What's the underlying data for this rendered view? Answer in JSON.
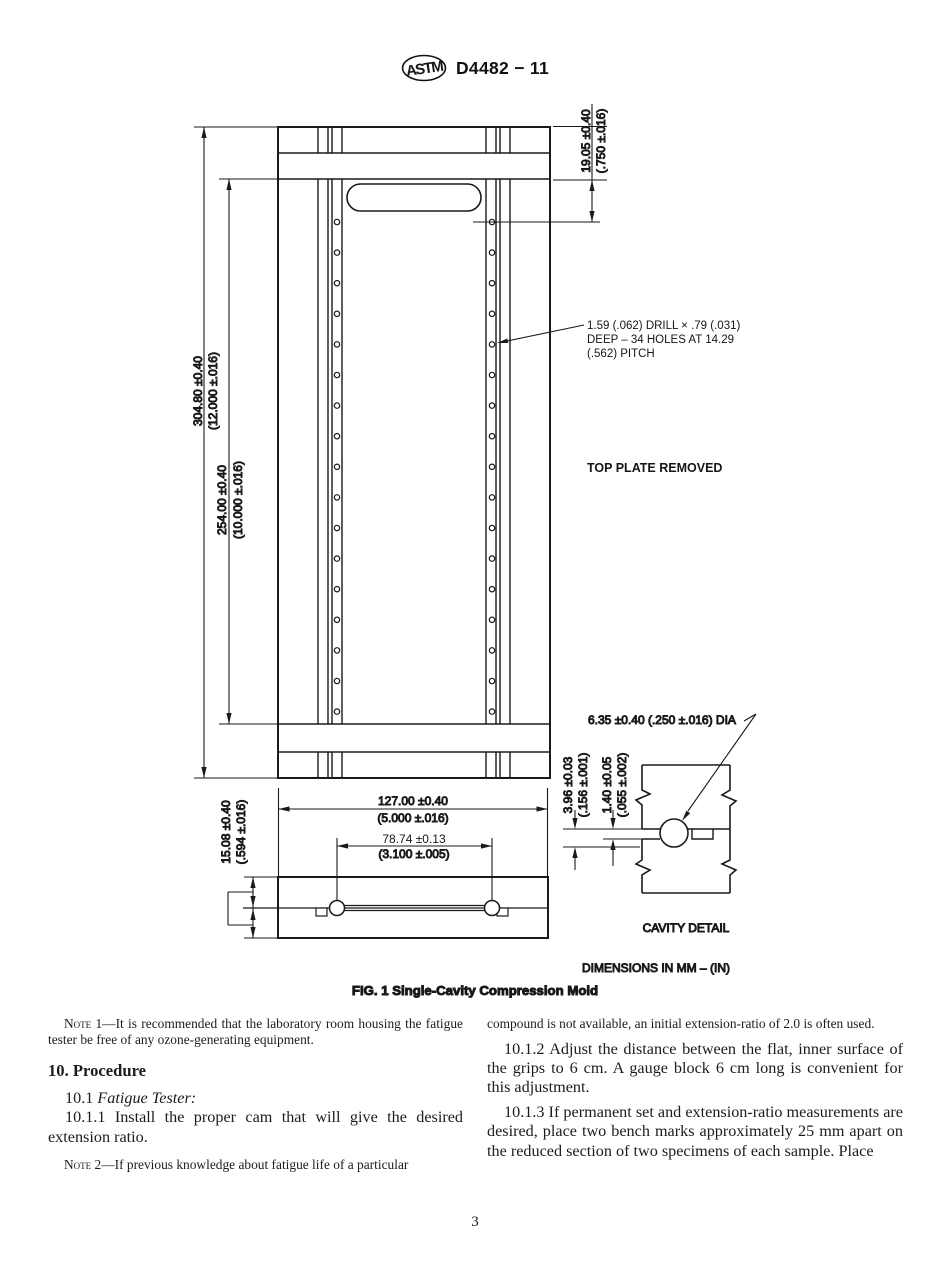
{
  "header": {
    "logo_text": "ASTM",
    "designation": "D4482 − 11"
  },
  "figure": {
    "caption": "FIG. 1 Single-Cavity Compression Mold",
    "units_note": "DIMENSIONS IN MM – (IN)",
    "top_plate_note": "TOP PLATE REMOVED",
    "cavity_detail_label": "CAVITY DETAIL",
    "drill_note_line1": "1.59 (.062) DRILL × .79 (.031)",
    "drill_note_line2": "DEEP – 34 HOLES AT 14.29",
    "drill_note_line3": "(.562) PITCH",
    "dims": {
      "overall_height_mm": "304.80 ±0.40",
      "overall_height_in": "(12.000 ±.016)",
      "rail_height_mm": "254.00 ±0.40",
      "rail_height_in": "(10.000 ±.016)",
      "top_offset_mm": "19.05 ±0.40",
      "top_offset_in": "(.750 ±.016)",
      "width_mm": "127.00 ±0.40",
      "width_in": "(5.000 ±.016)",
      "pin_span_mm": "78.74 ±0.13",
      "pin_span_in": "(3.100 ±.005)",
      "plate_thickness_mm": "15.08 ±0.40",
      "plate_thickness_in": "(.594 ±.016)",
      "cavity_depth_mm": "3.96 ±0.03",
      "cavity_depth_in": "(.156 ±.001)",
      "channel_depth_mm": "1.40 ±0.05",
      "channel_depth_in": "(.055 ±.002)",
      "pin_diameter": "6.35 ±0.40 (.250 ±.016) DIA"
    },
    "holes": {
      "columns_x": [
        337,
        492
      ],
      "count_per_column": 17,
      "start_y": 222,
      "pitch_y": 30.6,
      "radius": 2.7
    }
  },
  "content": {
    "left": {
      "note1_label": "Note 1",
      "note1_text": "—It is recommended that the laboratory room housing the fatigue tester be free of any ozone-generating equipment.",
      "heading": "10. Procedure",
      "s101_num": "10.1 ",
      "s101_title": "Fatigue Tester:",
      "s1011": "10.1.1 Install the proper cam that will give the desired extension ratio.",
      "note2_label": "Note 2",
      "note2_text": "—If previous knowledge about fatigue life of a particular"
    },
    "right": {
      "note2_cont": "compound is not available, an initial extension-ratio of 2.0 is often used.",
      "s1012": "10.1.2 Adjust the distance between the flat, inner surface of the grips to 6 cm. A gauge block 6 cm long is convenient for this adjustment.",
      "s1013": "10.1.3 If permanent set and extension-ratio measurements are desired, place two bench marks approximately 25 mm apart on the reduced section of two specimens of each sample. Place"
    }
  },
  "footer": {
    "page_number": "3"
  }
}
